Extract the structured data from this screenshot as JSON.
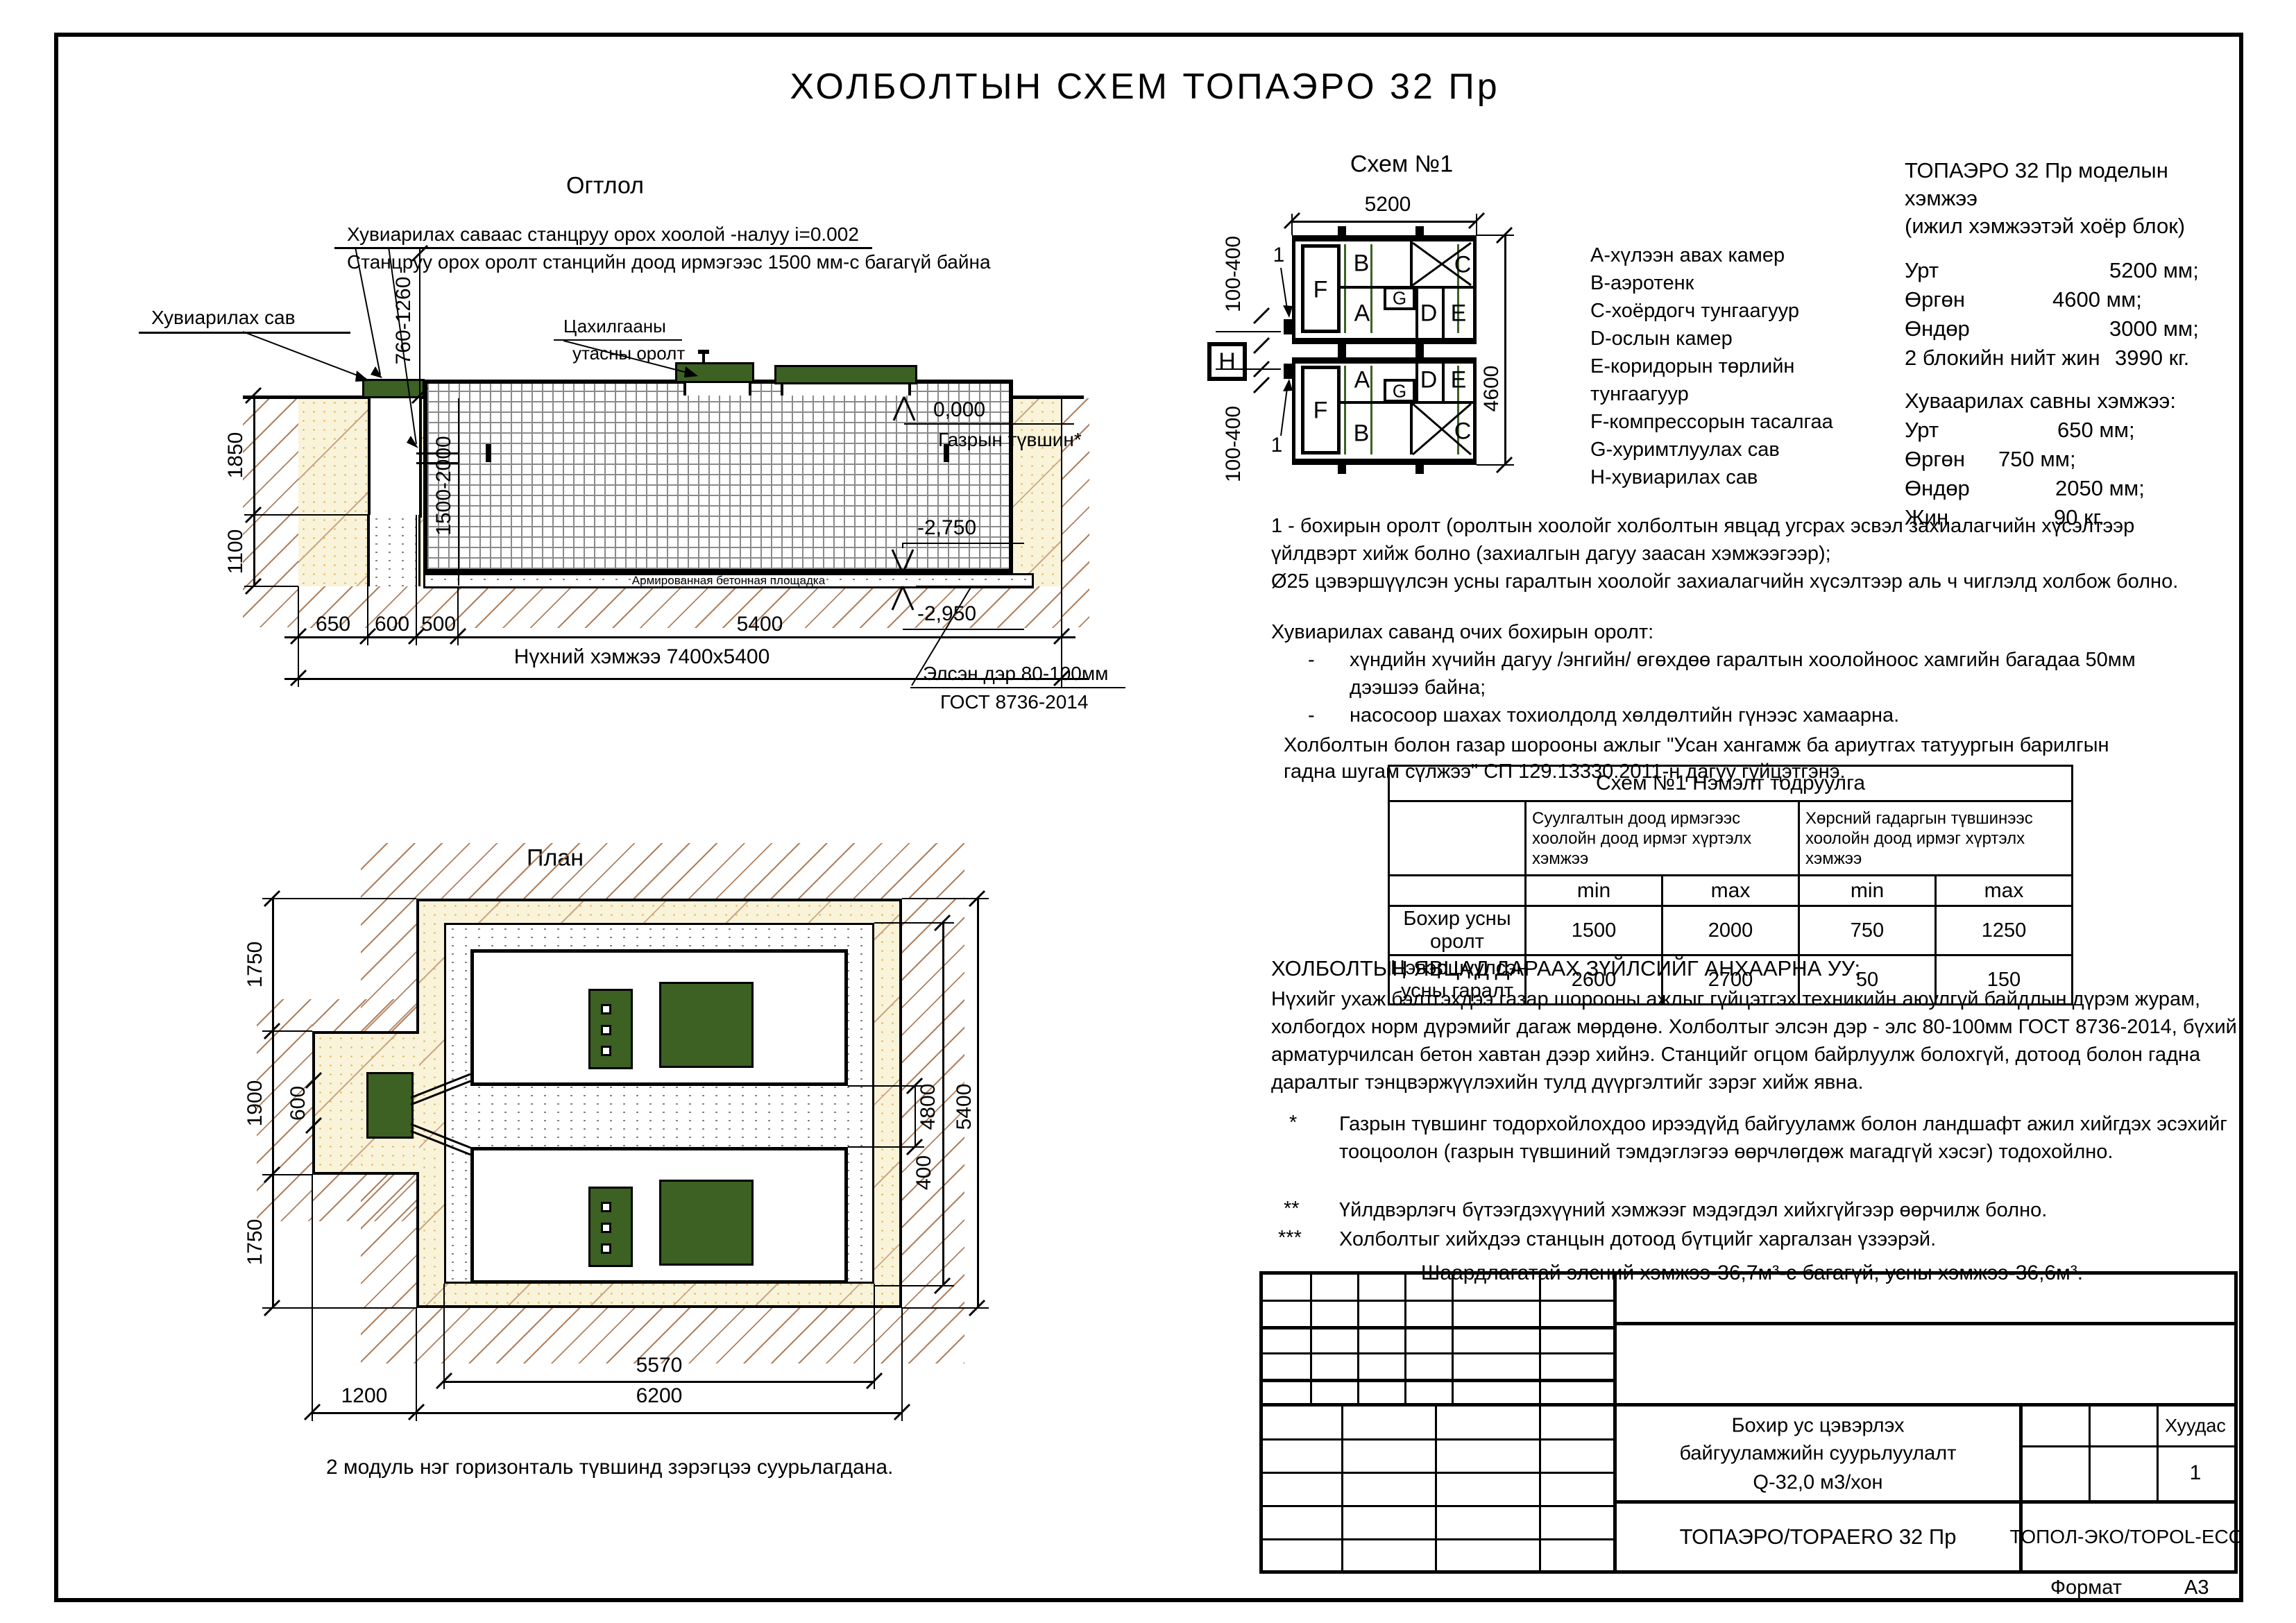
{
  "page": {
    "title": "ХОЛБОЛТЫН  СХЕМ  ТОПАЭРО  32  Пр",
    "format_label": "Формат",
    "format_value": "А3"
  },
  "colors": {
    "equipment_green": "#3c6123",
    "sand_fill": "#f9f3d9",
    "earth_hatch_brown": "#a06a42",
    "line_black": "#000000"
  },
  "section": {
    "title": "Огтлол",
    "note_line1": "Хувиарилах саваас станцруу орох хоолой -налуу i=0.002",
    "note_line2": "Станцруу орох оролт станцийн доод ирмэгээс 1500 мм-с багагүй байна",
    "distribution_label": "Хувиарилах сав",
    "electric_label_1": "Цахилгааны",
    "electric_label_2": "утасны оролт",
    "ground_level": "0,000",
    "ground_label": "Газрын түвшин*",
    "level_station_bottom": "-2,750",
    "level_pit_bottom": "-2,950",
    "sand_label_1": "Элсэн дэр 80-100мм",
    "sand_label_2": "ГОСТ 8736-2014",
    "concrete_label": "Армированная бетонная площадка",
    "dims": {
      "v760": "760-1260",
      "v1850": "1850",
      "v1100": "1100",
      "v1500": "1500-2000",
      "b650": "650",
      "b600": "600",
      "b500": "500",
      "b5400": "5400",
      "pit_total": "Нүхний хэмжээ 7400х5400"
    }
  },
  "plan": {
    "title": "План",
    "caption": "2 модуль нэг горизонталь түвшинд зэрэгцээ суурьлагдана.",
    "dims": {
      "l1750t": "1750",
      "l1900": "1900",
      "l600": "600",
      "l1750b": "1750",
      "r4800": "4800",
      "r5400": "5400",
      "r400": "400",
      "b1200": "1200",
      "b5570": "5570",
      "b6200": "6200"
    }
  },
  "schema": {
    "title": "Схем  №1",
    "dim_width": "5200",
    "dim_height": "4600",
    "dim_offset_top": "100-400",
    "dim_offset_bottom": "100-400",
    "callout_top": "1",
    "callout_bottom": "1",
    "h_label": "Н",
    "rooms": {
      "a": "A",
      "b": "B",
      "c": "C",
      "d": "D",
      "e": "E",
      "f": "F",
      "g": "G"
    },
    "legend": [
      "А-хүлээн авах камер",
      "В-аэротенк",
      "С-хоёрдогч тунгаагуур",
      "D-ослын камер",
      "Е-коридорын төрлийн",
      "тунгаагуур",
      "F-компрессорын тасалгаа",
      "G-хуримтлуулах сав",
      "Н-хувиарилах сав"
    ]
  },
  "specs": {
    "heading1": "ТОПАЭРО 32 Пр моделын",
    "heading2": "хэмжээ",
    "heading3": "(ижил хэмжээтэй хоёр блок)",
    "rows": [
      {
        "label": "Урт",
        "value": "5200 мм;"
      },
      {
        "label": "Өргөн",
        "value": "4600 мм;"
      },
      {
        "label": "Өндөр",
        "value": "3000 мм;"
      },
      {
        "label": "2 блокийн нийт жин",
        "value": "3990 кг."
      }
    ],
    "subheading": "Хуваарилах савны хэмжээ:",
    "rows2": [
      {
        "label": "Урт",
        "value": "650 мм;"
      },
      {
        "label": "Өргөн",
        "value": "750 мм;"
      },
      {
        "label": "Өндөр",
        "value": "2050 мм;"
      },
      {
        "label": "Жин",
        "value": "90 кг."
      }
    ]
  },
  "notes": {
    "p1a": "1 - бохирын оролт (оролтын хоолойг холболтын явцад угсрах эсвэл захиалагчийн хүсэлтээр",
    "p1b": "үйлдвэрт хийж болно (захиалгын дагуу заасан хэмжээгээр);",
    "p2": "Ø25 цэвэршүүлсэн усны гаралтын хоолойг захиалагчийн хүсэлтээр аль ч чиглэлд холбож болно.",
    "p3": "Хувиарилах саванд очих бохирын оролт:",
    "dash": "-",
    "b1a": "хүндийн хүчийн дагуу /энгийн/ өгөхдөө гаралтын хоолойноос хамгийн багадаа 50мм",
    "b1b": "дээшээ байна;",
    "b2": "насосоор шахах тохиолдолд хөлдөлтийн гүнээс хамаарна.",
    "p4a": "Холболтын болон газар шорооны ажлыг \"Усан хангамж ба ариутгах татуургын барилгын",
    "p4b": "гадна шугам сүлжээ\" СП 129.13330.2011-н дагуу гүйцэтгэнэ."
  },
  "table": {
    "title": "Схем №1 Нэмэлт тодруулга",
    "col_a": "Суулгалтын доод ирмэгээс хоолойн доод ирмэг хүртэлх хэмжээ",
    "col_b": "Хөрсний гадаргын түвшинээс хоолойн доод ирмэг хүртэлх хэмжээ",
    "min_label": "min",
    "max_label": "max",
    "rows": [
      {
        "label": "Бохир усны оролт",
        "v1": "1500",
        "v2": "2000",
        "v3": "750",
        "v4": "1250"
      },
      {
        "label": "Цэвэршүүлсэн усны гаралт",
        "v1": "2600",
        "v2": "2700",
        "v3": "50",
        "v4": "150"
      }
    ]
  },
  "warning": {
    "title": "ХОЛБОЛТЫН ЯВЦАД ДАРААХ ЗҮЙЛСИЙГ АНХААРНА УУ:",
    "body": "Нүхийг ухаж бэлтгэхдээ газар шорооны ажлыг гүйцэтгэх техникийн аюулгүй байдлын дүрэм журам, холбогдох норм дүрэмийг дагаж мөрдөнө. Холболтыг элсэн дэр - элс 80-100мм ГОСТ 8736-2014, бүхий арматурчилсан бетон хавтан дээр хийнэ. Станцийг огцом байрлуулж болохгүй, дотоод болон гадна даралтыг тэнцвэржүүлэхийн тулд дүүргэлтийг зэрэг хийж явна."
  },
  "footnotes": [
    {
      "mark": "*",
      "text": "Газрын түвшинг тодорхойлохдоо ирээдүйд байгууламж болон ландшафт ажил хийгдэх эсэхийг тооцоолон (газрын түвшиний тэмдэглэгээ өөрчлөгдөж магадгүй хэсэг) тодохойлно."
    },
    {
      "mark": "**",
      "text": "Үйлдвэрлэгч бүтээгдэхүүний хэмжээг мэдэгдэл хийхгүйгээр өөрчилж болно."
    },
    {
      "mark": "***",
      "text": "Холболтыг хийхдээ станцын дотоод бүтцийг харгалзан үзээрэй."
    }
  ],
  "sand_requirement": "Шаардлагатай элсний хэмжээ-36,7м³-с багагүй, усны хэмжээ-36,6м³.",
  "titleblock": {
    "desc_line1": "Бохир ус цэвэрлэх",
    "desc_line2": "байгууламжийн суурьлуулалт",
    "desc_line3": "Q-32,0 м3/хон",
    "model": "ТОПАЭРО/TOPAERO 32 Пр",
    "company": "ТОПОЛ-ЭКО/TOPOL-ECO",
    "sheet_label": "Хуудас",
    "sheet_number": "1"
  }
}
